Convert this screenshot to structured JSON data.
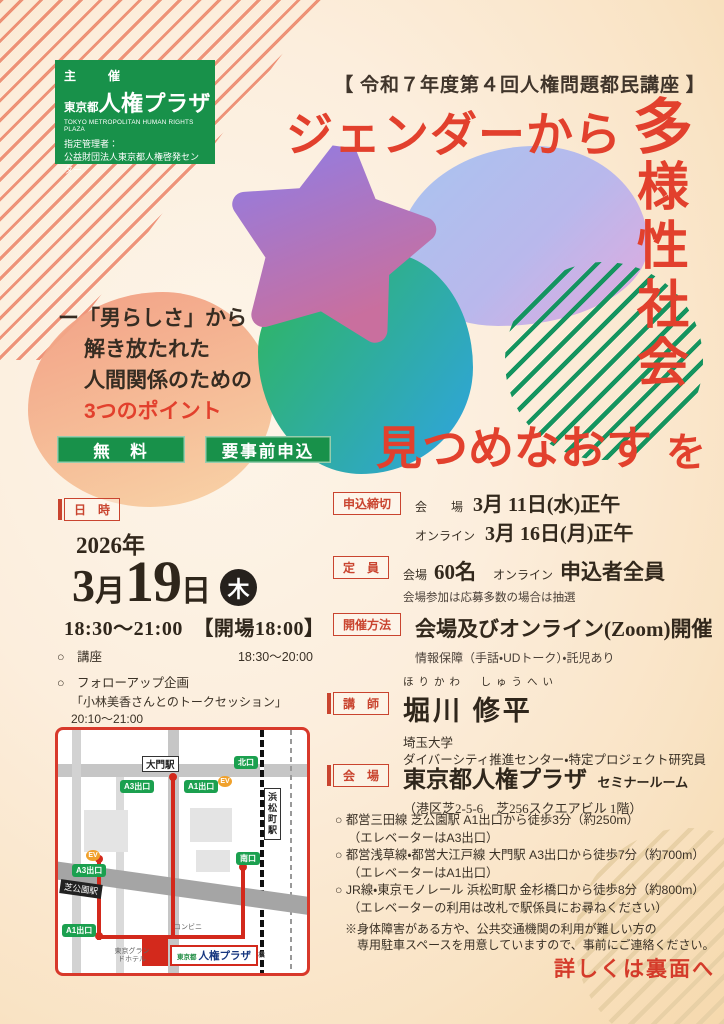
{
  "colors": {
    "accent_red": "#e2402d",
    "brand_green": "#18914a",
    "label_red": "#c9442f",
    "map_route_red": "#d3291c"
  },
  "organizer": {
    "role": "主　催",
    "name_prefix": "東京都",
    "name": "人権プラザ",
    "name_en": "TOKYO METROPOLITAN HUMAN RIGHTS PLAZA",
    "manager_label": "指定管理者：",
    "manager": "公益財団法人東京都人権啓発センター"
  },
  "header": {
    "series": "【 令和７年度第４回人権問題都民講座 】"
  },
  "title": {
    "line1": "ジェンダーから",
    "v1": "多",
    "v2": "様",
    "v3": "性",
    "v4": "社",
    "v5": "会",
    "line2": "見つめなおす",
    "particle": "を"
  },
  "lead": {
    "l1": "ー「男らしさ」から",
    "l2": "解き放たれた",
    "l3": "人間関係のための",
    "highlight": "3つのポイント"
  },
  "badges": {
    "free": "無　料",
    "reserve": "要事前申込"
  },
  "datetime": {
    "label": "日　時",
    "year": "2026年",
    "month_num": "3",
    "month_kanji": "月",
    "day": "19",
    "day_kanji": "日",
    "weekday": "木",
    "time": "18:30～21:00　【開場18:00】",
    "item1_name": "○　講座",
    "item1_time": "18:30～20:00",
    "item2_name": "○　フォローアップ企画",
    "item2_detail": "「小林美香さんとのトークセッション」20:10～21:00",
    "note1": "※講座のみの参加はできますが、フォローアップ企画",
    "note2": "のみの参加はできません。"
  },
  "map": {
    "daimon": "大門駅",
    "kita": "北口",
    "a3_top": "A3出口",
    "a1_top": "A1出口",
    "ev1": "EV",
    "ev2": "EV",
    "hamamatsucho": "浜松町駅",
    "minami": "南口",
    "shibakoen": "芝公園駅",
    "a3_mid": "A3出口",
    "a1_bottom": "A1出口",
    "hotel": "東京グランドホテル",
    "conbini": "コンビニ",
    "kanasugi": "金杉橋",
    "dest_prefix": "東京都",
    "dest": "人権プラザ"
  },
  "apply": {
    "label": "申込締切",
    "row1_key": "会　　場",
    "row1_val": "3月 11日(水)正午",
    "row2_key": "オンライン",
    "row2_val": "3月 16日(月)正午"
  },
  "capacity": {
    "label": "定　員",
    "k1": "会場",
    "v1": "60名",
    "k2": "オンライン",
    "v2": "申込者全員",
    "note": "会場参加は応募多数の場合は抽選"
  },
  "format": {
    "label": "開催方法",
    "main": "会場及びオンライン(Zoom)開催",
    "note": "情報保障（手話・UDトーク）・託児あり"
  },
  "lecturer": {
    "label": "講　師",
    "furigana": "ほりかわ　しゅうへい",
    "name": "堀川 修平",
    "aff1": "埼玉大学",
    "aff2": "ダイバーシティ推進センター・特定プロジェクト研究員"
  },
  "venue": {
    "label": "会　場",
    "name": "東京都人権プラザ",
    "room": "セミナールーム",
    "address": "（港区芝2-5-6　芝256スクエアビル 1階）"
  },
  "access": {
    "i1": "○ 都営三田線 芝公園駅 A1出口から徒歩3分（約250m）",
    "i1s": "（エレベーターはA3出口）",
    "i2": "○ 都営浅草線・都営大江戸線 大門駅 A3出口から徒歩7分（約700m）",
    "i2s": "（エレベーターはA1出口）",
    "i3": "○ JR線・東京モノレール 浜松町駅 金杉橋口から徒歩8分（約800m）",
    "i3s": "（エレベーターの利用は改札で駅係員にお尋ねください）",
    "note1": "※身体障害がある方や、公共交通機関の利用が難しい方の",
    "note2": "専用駐車スペースを用意していますので、事前にご連絡ください。"
  },
  "footer": {
    "more": "詳しくは裏面へ"
  }
}
